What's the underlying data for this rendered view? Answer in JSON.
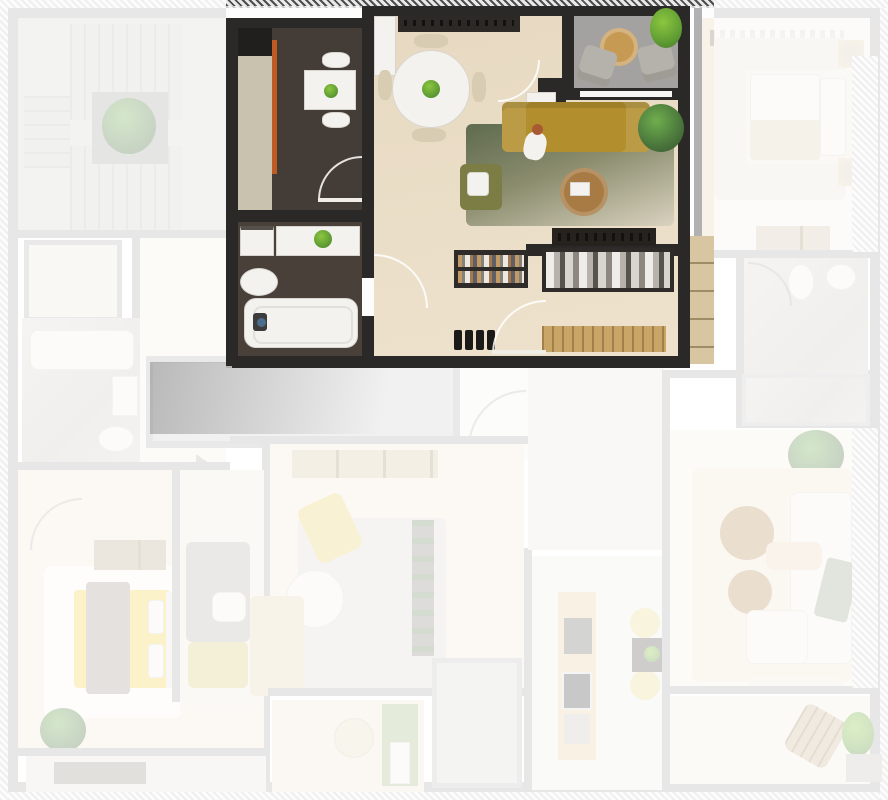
{
  "scene": {
    "type": "apartment-building-floorplan-3d-render",
    "view": "top-down",
    "highlighted_unit": {
      "rooms": [
        {
          "name": "kitchen",
          "floor": "dark-tile",
          "furniture": [
            "kitchen-counter",
            "upper-cabinets",
            "small-dining-table",
            "two-white-chairs",
            "table-plant"
          ]
        },
        {
          "name": "living-dining-room",
          "floor": "light-wood",
          "furniture": [
            "round-dining-table",
            "four-dining-chairs",
            "sideboard",
            "mustard-sofa",
            "green-gradient-rug",
            "bronze-coffee-table",
            "olive-lounge-chair",
            "tv-console",
            "potted-plant",
            "person-sitting",
            "tall-white-closet",
            "side-shelf"
          ]
        },
        {
          "name": "bathroom",
          "floor": "dark-tile",
          "furniture": [
            "vanity-counter",
            "washer",
            "toilet",
            "bathtub",
            "vanity-plant"
          ]
        },
        {
          "name": "hallway",
          "floor": "light-wood",
          "furniture": [
            "open-bookshelf",
            "open-wardrobe",
            "shoe-rack",
            "entry-bench",
            "entry-door",
            "wall-cabinets"
          ]
        },
        {
          "name": "balcony",
          "floor": "gray-deck",
          "furniture": [
            "two-gray-armchairs",
            "round-wood-table",
            "balcony-plant",
            "glass-sliding-door"
          ]
        }
      ]
    },
    "dimmed_areas": [
      {
        "name": "stairwell",
        "features": [
          "stair-flights",
          "central-planter"
        ]
      },
      {
        "name": "left-storage-room",
        "features": []
      },
      {
        "name": "left-bathroom",
        "features": [
          "bathtub",
          "sink",
          "toilet"
        ]
      },
      {
        "name": "middle-gray-room",
        "features": []
      },
      {
        "name": "central-corridor",
        "features": [
          "door-swing"
        ]
      },
      {
        "name": "bedroom-bottom-left",
        "features": [
          "yellow-bed",
          "gray-throw",
          "white-rug",
          "wall-shelf",
          "plant",
          "balcony-mat"
        ]
      },
      {
        "name": "sofa-room-bottom-left",
        "features": [
          "gray-sofa",
          "person",
          "yellow-chaise"
        ]
      },
      {
        "name": "living-room-bottom-center",
        "features": [
          "wardrobe-row",
          "gray-rug",
          "yellow-armchair",
          "round-coffee-table",
          "bookshelf",
          "beige-sofa"
        ]
      },
      {
        "name": "balcony-bottom-center",
        "features": [
          "round-pouf",
          "planter-box"
        ]
      },
      {
        "name": "bathroom-bottom-center",
        "features": []
      },
      {
        "name": "kitchen-bottom-center",
        "features": [
          "wood-counter",
          "fridge",
          "stove",
          "sink",
          "dark-table",
          "two-yellow-chairs"
        ]
      },
      {
        "name": "bedroom-top-right",
        "features": [
          "double-bed",
          "pillows",
          "beige-blanket",
          "rug",
          "two-nightstands",
          "dresser",
          "curtains"
        ]
      },
      {
        "name": "bathroom-top-right",
        "features": [
          "toilet",
          "sink",
          "shower-drain"
        ]
      },
      {
        "name": "living-room-bottom-right",
        "features": [
          "white-sofa",
          "person-lying",
          "two-round-tables",
          "large-plant",
          "tv-bench",
          "rug"
        ]
      },
      {
        "name": "balcony-bottom-right",
        "features": [
          "rattan-lounge-chair",
          "plant",
          "gray-mat"
        ]
      }
    ]
  },
  "palette": {
    "unit_wall": "#2b2927",
    "dim_wall": "#b1b0b3",
    "wood_floor": "#e9dcc5",
    "dark_floor": "#443c36",
    "sofa_mustard": "#b28e2c",
    "rug_green": "#5f6b4f",
    "rug_fade": "#d9d2bf",
    "coffee_table_bronze": "#a87a44",
    "lounge_olive": "#7c7d45",
    "accent_orange": "#bf5a22",
    "counter_greige": "#c8c2af",
    "balcony_floor": "#a4a2a0",
    "armchair_gray": "#b5b2ab",
    "wood_table": "#c79a54",
    "plant_green": "#4c7a3c",
    "plant_bright": "#67a23b",
    "bed_yellow": "#f2d24f",
    "blanket_gray": "#a49c93",
    "chaise_yellow": "#d9c878",
    "kitchen_counter_wood": "#e6d0a6",
    "dim_overlay": "rgba(255,255,255,0.70)"
  }
}
